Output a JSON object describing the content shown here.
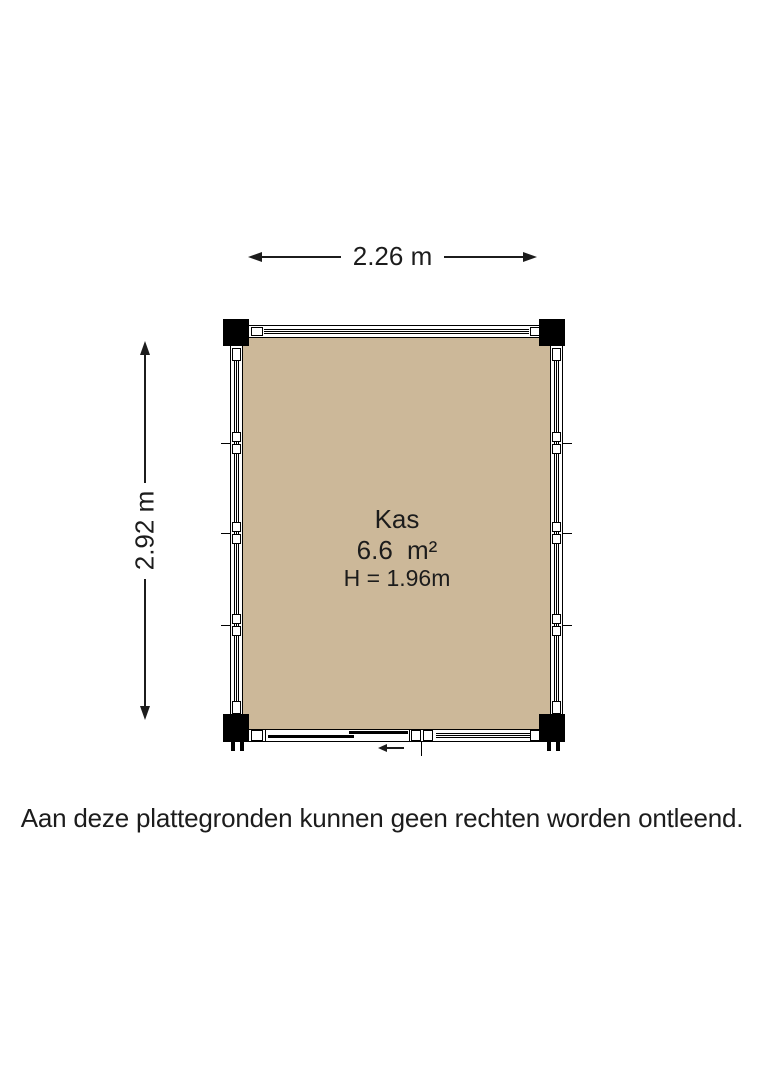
{
  "page": {
    "background_color": "#ffffff",
    "ink_color": "#1c1c1c"
  },
  "dimensions": {
    "width": {
      "label": "2.26 m"
    },
    "height": {
      "label": "2.92 m"
    }
  },
  "room": {
    "name": "Kas",
    "area": "6.6 m²",
    "ceiling_height": "H = 1.96m",
    "floor_color": "#ccb899",
    "wall_color": "#000000"
  },
  "disclaimer": "Aan deze plattegronden kunnen geen rechten worden ontleend."
}
